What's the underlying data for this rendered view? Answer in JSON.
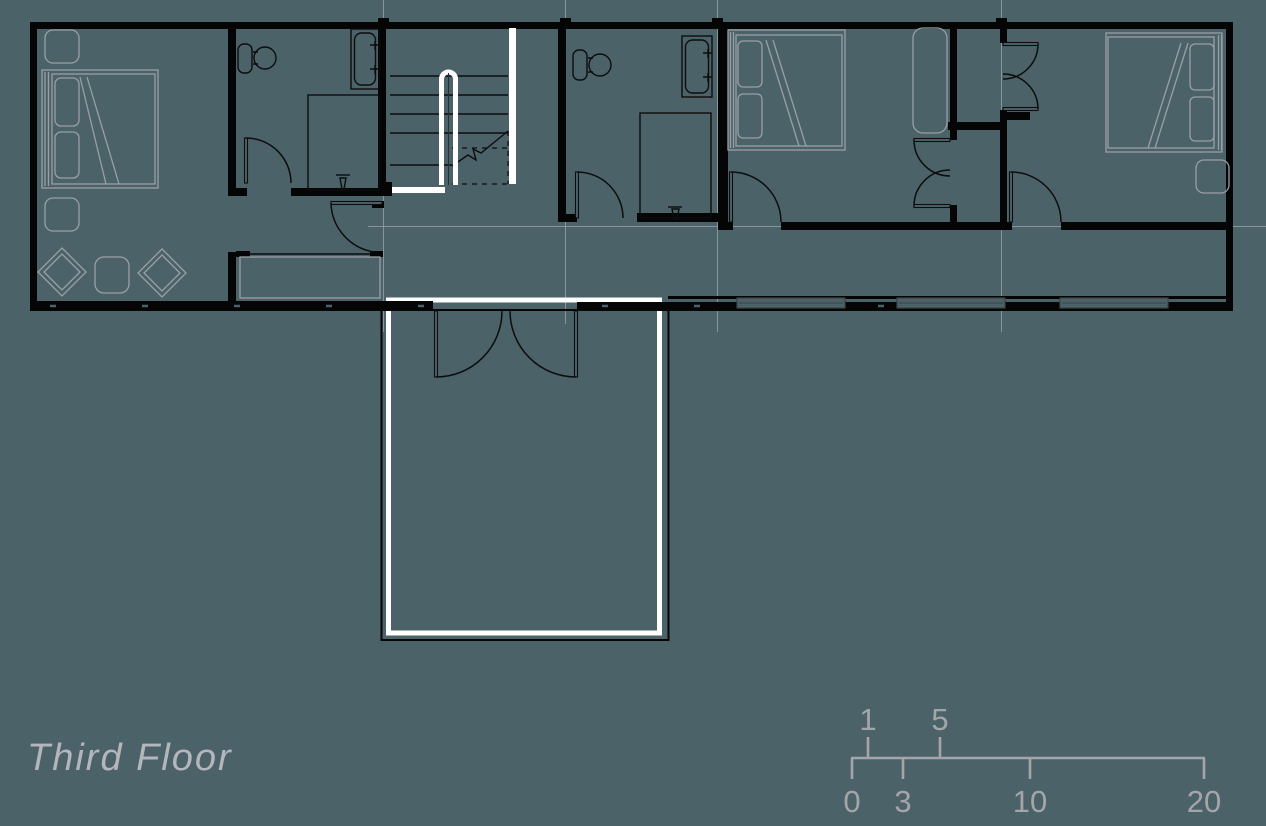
{
  "title": "Third Floor",
  "colors": {
    "background": "#4c6269",
    "walls": "#050505",
    "fixture_line": "#0d0d0d",
    "furniture_line": "#99a0a4",
    "highlight": "#ffffff",
    "grid_line": "#93a0a5",
    "window_line": "#3d4347",
    "title_text": "#b4b6bc",
    "scale_text": "#a3a5a9"
  },
  "scale_bar": {
    "labels_above": [
      "1",
      "5"
    ],
    "labels_below": [
      "0",
      "3",
      "10",
      "20"
    ]
  }
}
